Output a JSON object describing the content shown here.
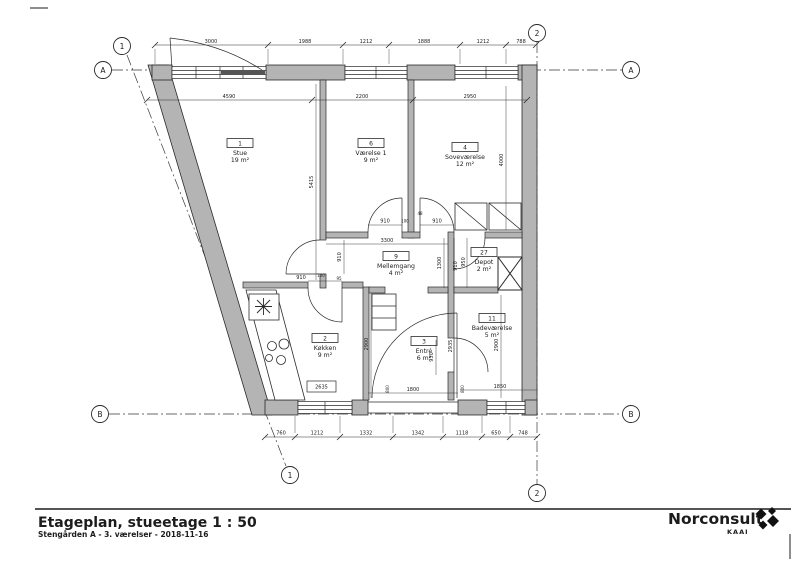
{
  "drawing": {
    "grid": {
      "col1": "1",
      "col2": "2",
      "rowA": "A",
      "rowB": "B"
    },
    "rooms": [
      {
        "number": "1",
        "name": "Stue",
        "area": "19 m²"
      },
      {
        "number": "6",
        "name": "Værelse 1",
        "area": "9 m²"
      },
      {
        "number": "4",
        "name": "Soveværelse",
        "area": "12 m²"
      },
      {
        "number": "9",
        "name": "Mellemgang",
        "area": "4 m²"
      },
      {
        "number": "27",
        "name": "Depot",
        "area": "2 m²"
      },
      {
        "number": "11",
        "name": "Badeværelse",
        "area": "5 m²"
      },
      {
        "number": "2",
        "name": "Køkken",
        "area": "9 m²"
      },
      {
        "number": "3",
        "name": "Entré",
        "area": "6 m²"
      }
    ],
    "dims": {
      "top": [
        "3000",
        "1988",
        "1212",
        "1888",
        "1212",
        "788"
      ],
      "upper": [
        "4590",
        "2200",
        "2950"
      ],
      "bottom": [
        "760",
        "1212",
        "1332",
        "1342",
        "1118",
        "650",
        "748"
      ],
      "interior": {
        "stue_h": "5415",
        "sove_h": "4000",
        "door_l": "910",
        "gap_100": "100",
        "gap_48": "48",
        "door_r": "910",
        "hall_w": "3300",
        "stue_door": "910",
        "hall_h": "1300",
        "depot_l": "910",
        "depot_w": "950",
        "kitchen_door": "910",
        "kitchen_gap100": "100",
        "kitchen_gap95": "95",
        "kitchen_h": "2900",
        "entre_pass": "930",
        "entre_h": "2935",
        "bath_h": "2900",
        "entrance_w": "1800",
        "bath_w": "1850",
        "counter_tag": "2635",
        "sill_a": "800",
        "sill_b": "800"
      }
    }
  },
  "title_block": {
    "title": "Etageplan, stueetage  1 : 50",
    "subtitle": "Stengården A - 3. værelser - 2018-11-16"
  },
  "logo": {
    "brand": "Norconsult",
    "sub": "KAAI"
  },
  "colors": {
    "wall": "#b4b4b4",
    "line": "#2a2a2a"
  }
}
